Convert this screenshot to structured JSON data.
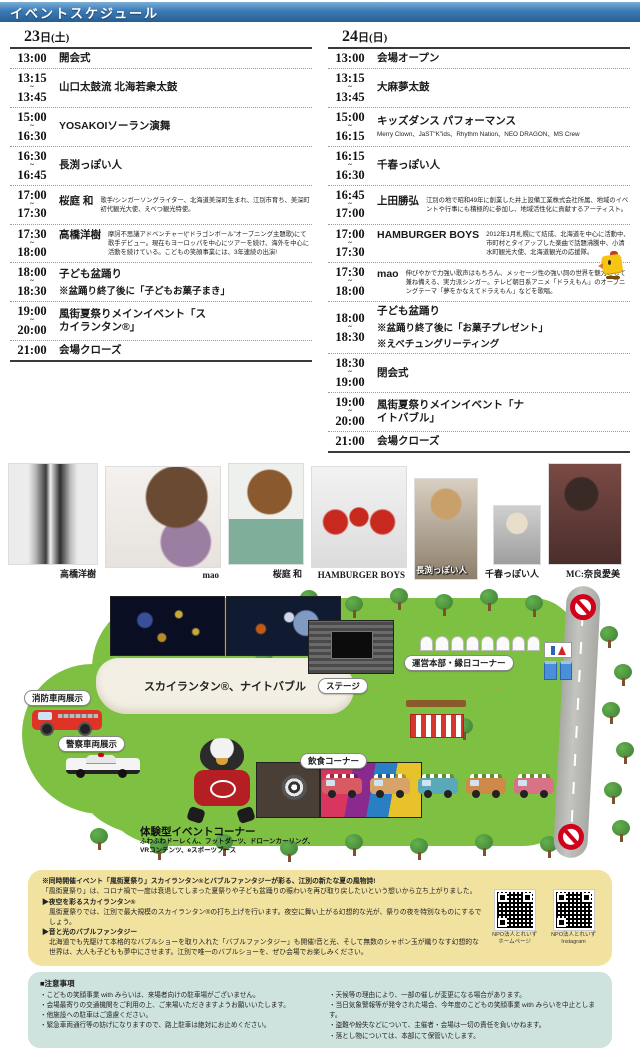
{
  "colors": {
    "header_blue": "#3c7ab5",
    "map_green": "#7ec142",
    "note_yellow_bg": "#f2e2a0",
    "note_blue_bg": "#cfe3de",
    "no_entry_red": "#d0021b"
  },
  "header": {
    "title": "イベントスケジュール"
  },
  "schedule": {
    "left": {
      "date_num": "23",
      "date_rest": "日(土)",
      "rows": [
        {
          "start": "13:00",
          "tilde": "",
          "end": "",
          "title": "開会式"
        },
        {
          "start": "13:15",
          "tilde": "~",
          "end": "13:45",
          "title": "山口太鼓流 北海若衆太鼓"
        },
        {
          "start": "15:00",
          "tilde": "~",
          "end": "16:30",
          "title": "YOSAKOIソーラン演舞"
        },
        {
          "start": "16:30",
          "tilde": "~",
          "end": "16:45",
          "title": "長渕っぽい人"
        },
        {
          "start": "17:00",
          "tilde": "~",
          "end": "17:30",
          "title": "桜庭 和",
          "desc": "歌手/シンガーソングライター、北海道美深町生まれ、江別市育ち、美深町初代観光大使、えべつ観光特使。"
        },
        {
          "start": "17:30",
          "tilde": "~",
          "end": "18:00",
          "title": "高橋洋樹",
          "desc": "摩訶不思議アドベンチャー!(“ドラゴンボール”オープニング主題歌)にて歌手デビュー。現在もヨーロッパを中心にツアーを続け、海外を中心に活動を続けている。こどもの笑顔事業には、3年連続の出演!"
        },
        {
          "start": "18:00",
          "tilde": "~",
          "end": "18:30",
          "title": "子ども盆踊り",
          "note1": "※盆踊り終了後に「子どもお菓子まき」"
        },
        {
          "start": "19:00",
          "tilde": "~",
          "end": "20:00",
          "title": "風街夏祭りメインイベント「スカイランタン®」"
        },
        {
          "start": "21:00",
          "tilde": "",
          "end": "",
          "title": "会場クローズ"
        }
      ]
    },
    "right": {
      "date_num": "24",
      "date_rest": "日(日)",
      "rows": [
        {
          "start": "13:00",
          "tilde": "",
          "end": "",
          "title": "会場オープン"
        },
        {
          "start": "13:15",
          "tilde": "~",
          "end": "13:45",
          "title": "大麻夢太鼓"
        },
        {
          "start": "15:00",
          "tilde": "~",
          "end": "16:15",
          "title": "キッズダンス パフォーマンス",
          "sub": "Merry Clown、JaST\"K\"ids、Rhythm Nation、NEO DRAGON、MS Crew"
        },
        {
          "start": "16:15",
          "tilde": "~",
          "end": "16:30",
          "title": "千春っぽい人"
        },
        {
          "start": "16:45",
          "tilde": "~",
          "end": "17:00",
          "title": "上田勝弘",
          "desc": "江別の地で昭和49年に創業した井上設備工業株式会社所属、地域のイベントや行事にも積極的に参加し、地域活性化に貢献するアーティスト。"
        },
        {
          "start": "17:00",
          "tilde": "~",
          "end": "17:30",
          "title": "HAMBURGER BOYS",
          "desc": "2012年1月札幌にて結成、北海道を中心に活動中、市町村とタイアップした楽曲で話題沸騰中、小清水町観光大使、北海道観光の応援隊。"
        },
        {
          "start": "17:30",
          "tilde": "~",
          "end": "18:00",
          "title": "mao",
          "desc": "伸びやかで力強い歌声はもちろん、メッセージ性の強い詞の世界を魅力として兼ね備える、実力派シンガー。テレビ朝日系アニメ「ドラえもん」のオープニングテーマ「夢をかなえてドラえもん」などを歌唱。"
        },
        {
          "start": "18:00",
          "tilde": "~",
          "end": "18:30",
          "title": "子ども盆踊り",
          "note1": "※盆踊り終了後に「お菓子プレゼント」",
          "note2": "※えべチュングリーティング"
        },
        {
          "start": "18:30",
          "tilde": "~",
          "end": "19:00",
          "title": "閉会式"
        },
        {
          "start": "19:00",
          "tilde": "~",
          "end": "20:00",
          "title": "風街夏祭りメインイベント「ナイトバブル」"
        },
        {
          "start": "21:00",
          "tilde": "",
          "end": "",
          "title": "会場クローズ"
        }
      ]
    }
  },
  "performers": [
    {
      "id": "takahashi",
      "name": "高橋洋樹"
    },
    {
      "id": "maop",
      "name": "mao"
    },
    {
      "id": "sakuraba",
      "name": "桜庭 和"
    },
    {
      "id": "hamburger",
      "name": "HAMBURGER BOYS"
    },
    {
      "id": "nagabuchi",
      "name": "長渕っぽい人"
    },
    {
      "id": "chiharu",
      "name": "千春っぽい人"
    },
    {
      "id": "mcph",
      "name": "MC:奈良愛美"
    }
  ],
  "map": {
    "lantern_zone": "スカイランタン®、ナイトバブル",
    "fire": "消防車両展示",
    "police": "警察車両展示",
    "stage": "ステージ",
    "hq": "運営本部・縁日コーナー",
    "food": "飲食コーナー",
    "taiken_title": "体験型イベントコーナー",
    "taiken_line1": "ふわふわドーレくん、フットダーツ、ドローンカーリング、",
    "taiken_line2": "VRコンテンツ、eスポーツブース"
  },
  "yellow_note": {
    "lines": [
      {
        "s": "b",
        "t": "※同時開催イベント「風街夏祭り」スカイランタン®とバブルファンタジーが彩る、江別の新たな夏の風物詩!"
      },
      {
        "s": "n",
        "t": "「風街夏祭り」は、コロナ禍で一度は衰退してしまった夏祭りや子ども盆踊りの賑わいを再び取り戻したいという想いから立ち上がりました。"
      },
      {
        "s": "h",
        "t": "▶夜空を彩るスカイランタン®"
      },
      {
        "s": "i",
        "t": "風街夏祭りでは、江別で最大規模のスカイランタン®の打ち上げを行います。夜空に舞い上がる幻想的な光が、祭りの夜を特別なものにするでしょう。"
      },
      {
        "s": "h",
        "t": "▶音と光のバブルファンタジー"
      },
      {
        "s": "i",
        "t": "北海道でも先駆けて本格的なバブルショーを取り入れた「バブルファンタジー」も開催!音と光、そして無数のシャボン玉が織りなす幻想的な世界は、大人も子どもも夢中にさせます。江別で唯一のバブルショーを、ぜひ会場でお楽しみください。"
      }
    ]
  },
  "qr": [
    {
      "line1": "NPO法人とれいず",
      "line2": "ホームページ"
    },
    {
      "line1": "NPO法人とれいず",
      "line2": "Instagram"
    }
  ],
  "blue_note": {
    "title": "■注意事項",
    "left": [
      "・こどもの笑顔事業 with みらいは、来場者向けの駐車場がございません。",
      "・会場最寄りの交通機関をご利用の上、ご来場いただきますようお願いいたします。",
      "・他施設への駐車はご遠慮ください。",
      "・緊急車両通行等の妨げになりますので、路上駐車は絶対にお止めください。"
    ],
    "right": [
      "・天候等の理由により、一部の催しが変更になる場合があります。",
      "・当日気象警報等が発令された場合、今年度のこどもの笑顔事業 with みらいを中止とします。",
      "・盗難や紛失などについて、主催者・会場は一切の責任を負いかねます。",
      "・落とし物については、本部にて保管いたします。"
    ]
  }
}
